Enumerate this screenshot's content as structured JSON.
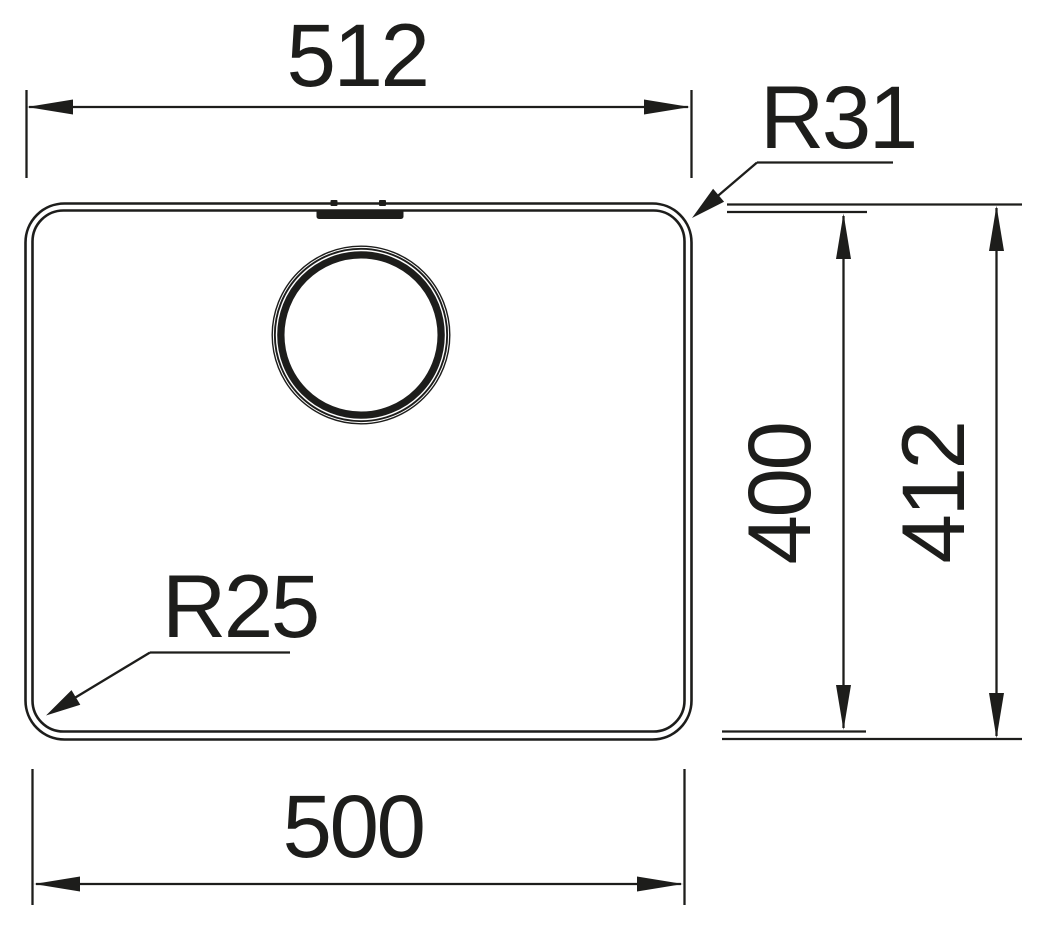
{
  "colors": {
    "ink": "#1d1d1b",
    "background": "#ffffff"
  },
  "drawing": {
    "type": "technical-dimension-drawing",
    "subject": "kitchen-sink-bowl-top-view",
    "dimensions": {
      "outer_width": "512",
      "inner_width": "500",
      "inner_depth": "400",
      "outer_depth": "412",
      "outer_corner_radius": "R31",
      "inner_corner_radius": "R25"
    }
  }
}
